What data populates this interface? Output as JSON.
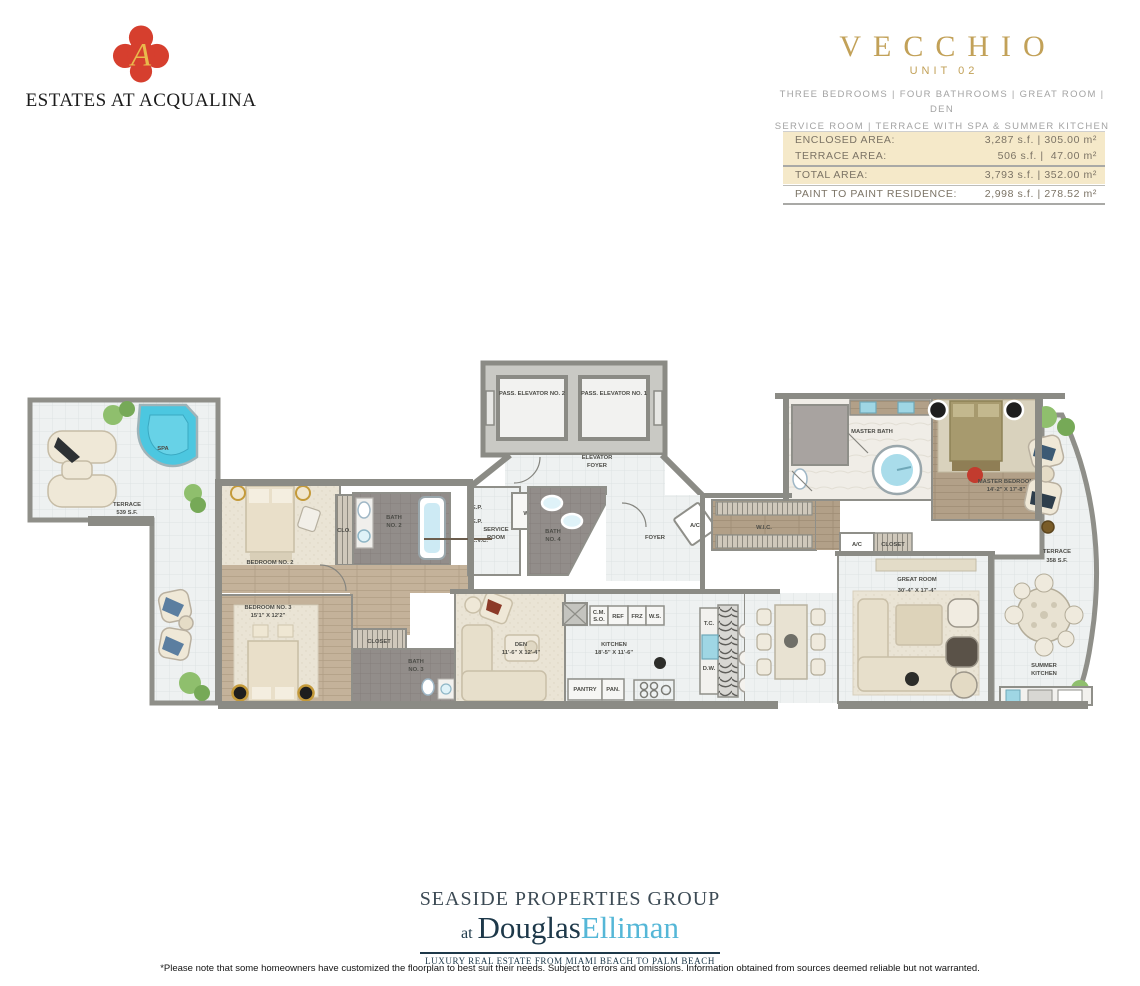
{
  "header": {
    "brand_name": "ESTATES AT ACQUALINA",
    "logo_monogram": "A",
    "plan": {
      "title": "VECCHIO",
      "unit": "UNIT 02",
      "features_line1": "THREE BEDROOMS | FOUR BATHROOMS | GREAT ROOM | DEN",
      "features_line2": "SERVICE ROOM | TERRACE WITH SPA & SUMMER KITCHEN"
    }
  },
  "area_table": {
    "rows": [
      {
        "label": "ENCLOSED AREA:",
        "value": "3,287 s.f. | 305.00 m²"
      },
      {
        "label": "TERRACE AREA:",
        "value": "506 s.f. |  47.00 m²"
      },
      {
        "label": "TOTAL AREA:",
        "value": "3,793 s.f. | 352.00 m²"
      },
      {
        "label": "PAINT TO PAINT RESIDENCE:",
        "value": "2,998 s.f. | 278.52 m²"
      }
    ]
  },
  "floorplan": {
    "labels": {
      "elevator2": "PASS. ELEVATOR NO. 2",
      "elevator1": "PASS. ELEVATOR NO. 1",
      "elevator_foyer_1": "ELEVATOR",
      "elevator_foyer_2": "FOYER",
      "terrace_left_1": "TERRACE",
      "terrace_left_2": "539 S.F.",
      "spa": "SPA",
      "bedroom2_1": "BEDROOM NO. 2",
      "bedroom2_2": "13'6\" X 11'10\"",
      "bath2_1": "BATH",
      "bath2_2": "NO. 2",
      "clo": "CLO.",
      "wd": "W/D",
      "service_1": "SERVICE",
      "service_2": "ROOM",
      "bath4_1": "BATH",
      "bath4_2": "NO. 4",
      "ep": "E.P.",
      "lvc": "L.V.C.",
      "foyer": "FOYER",
      "ac": "A/C",
      "wic": "W.I.C.",
      "closet": "CLOSET",
      "master_bath": "MASTER BATH",
      "master_bedroom_1": "MASTER BEDROOM",
      "master_bedroom_2": "14'-2\" X 17'-8\"",
      "bedroom3_1": "BEDROOM NO. 3",
      "bedroom3_2": "15'1\" X 12'2\"",
      "bath3_1": "BATH",
      "bath3_2": "NO. 3",
      "den_1": "DEN",
      "den_2": "11'-6\" X 12'-4\"",
      "kitchen_1": "KITCHEN",
      "kitchen_2": "18'-5\" X 11'-6\"",
      "cm_1": "C.M.",
      "cm_2": "S.O.",
      "ref": "REF",
      "frz": "FRZ",
      "ws": "W.S.",
      "pantry": "PANTRY",
      "pan": "PAN.",
      "tc": "T.C.",
      "dw": "D.W.",
      "great_room_1": "GREAT ROOM",
      "great_room_2": "30'-4\" X 17'-4\"",
      "terrace_right_1": "TERRACE",
      "terrace_right_2": "358 S.F.",
      "summer_kitchen_1": "SUMMER",
      "summer_kitchen_2": "KITCHEN"
    }
  },
  "footer": {
    "group": "SEASIDE PROPERTIES GROUP",
    "at": "at",
    "brand_dark": "Douglas",
    "brand_light": "Elliman",
    "tagline": "LUXURY REAL ESTATE FROM MIAMI BEACH TO PALM BEACH",
    "disclaimer": "*Please note that some homeowners have customized the floorplan to best suit their needs. Subject to errors and omissions. Information obtained from sources deemed reliable but not warranted."
  },
  "colors": {
    "gold": "#c2a158",
    "table_beige": "#f5e9c9",
    "logo_red": "#d63f2e",
    "logo_gold": "#e9b94c",
    "elliman_blue": "#55b7d7",
    "spa_blue": "#4cc7e0",
    "wall_gray": "#8b8b85",
    "tile_floor": "#eef1f1",
    "wood_floor": "#c4b29a"
  }
}
